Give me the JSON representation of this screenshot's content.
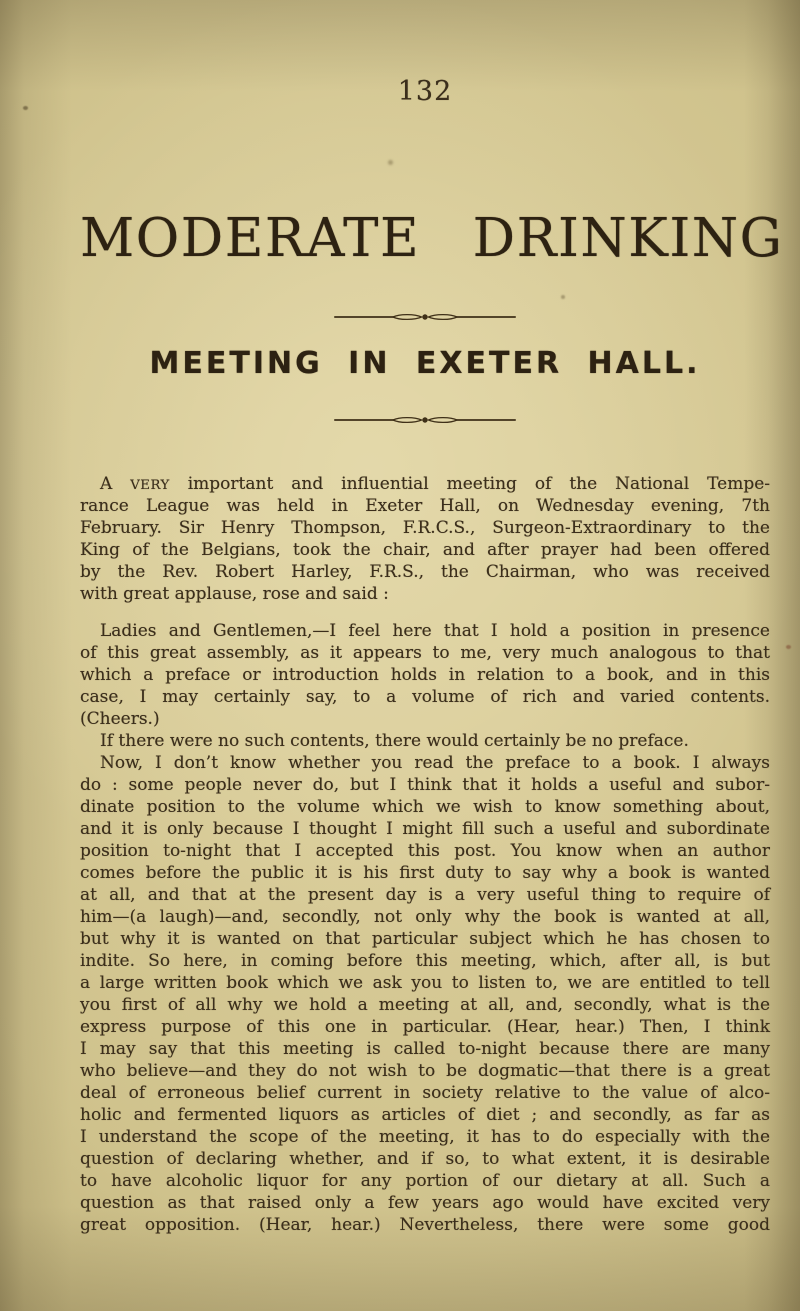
{
  "page_number": "132",
  "title": "MODERATE DRINKING",
  "heading": "MEETING IN EXETER HALL.",
  "ornament": "spindle-rule",
  "colors": {
    "paper": "#cfc28c",
    "paper_light": "#dbce9b",
    "paper_dark": "#a79860",
    "ink": "#3b2e1b",
    "ink_dark": "#2d2212",
    "rule": "#3f3018"
  },
  "body": {
    "paragraphs": [
      {
        "indent": true,
        "gap_before": 0,
        "lines": [
          {
            "justify": true,
            "segments": [
              {
                "s": "A "
              },
              {
                "s": "VERY",
                "sc": true
              },
              {
                "s": " important and influential meeting of the National Tempe-"
              }
            ]
          },
          {
            "justify": true,
            "segments": [
              {
                "s": "rance League was held in Exeter Hall, on Wednesday evening, 7th"
              }
            ]
          },
          {
            "justify": true,
            "segments": [
              {
                "s": "February. Sir Henry Thompson, F.R.C.S., Surgeon-Extraordinary to the"
              }
            ]
          },
          {
            "justify": true,
            "segments": [
              {
                "s": "King of the Belgians, took the chair, and after prayer had been offered"
              }
            ]
          },
          {
            "justify": true,
            "segments": [
              {
                "s": "by the Rev. Robert Harley, F.R.S., the Chairman, who was received"
              }
            ]
          },
          {
            "justify": false,
            "segments": [
              {
                "s": "with great applause, rose and said :"
              }
            ]
          }
        ]
      },
      {
        "indent": true,
        "gap_before": 15,
        "lines": [
          {
            "justify": true,
            "segments": [
              {
                "s": "Ladies and Gentlemen,—I feel here that I hold a position in presence"
              }
            ]
          },
          {
            "justify": true,
            "segments": [
              {
                "s": "of this great assembly, as it appears to me, very much analogous to that"
              }
            ]
          },
          {
            "justify": true,
            "segments": [
              {
                "s": "which a preface or introduction holds in relation to a book, and in this"
              }
            ]
          },
          {
            "justify": true,
            "segments": [
              {
                "s": "case, I may certainly say, to a volume of rich and varied contents."
              }
            ]
          },
          {
            "justify": false,
            "segments": [
              {
                "s": "(Cheers.)"
              }
            ]
          }
        ]
      },
      {
        "indent": true,
        "gap_before": 0,
        "lines": [
          {
            "justify": false,
            "segments": [
              {
                "s": "If there were no such contents, there would certainly be no preface."
              }
            ]
          }
        ]
      },
      {
        "indent": true,
        "gap_before": 0,
        "lines": [
          {
            "justify": true,
            "segments": [
              {
                "s": "Now, I don’t know whether you read the preface to a book. I always"
              }
            ]
          },
          {
            "justify": true,
            "segments": [
              {
                "s": "do : some people never do, but I think that it holds a useful and subor-"
              }
            ]
          },
          {
            "justify": true,
            "segments": [
              {
                "s": "dinate position to the volume which we wish to know something about,"
              }
            ]
          },
          {
            "justify": true,
            "segments": [
              {
                "s": "and it is only because I thought I might fill such a useful and subordinate"
              }
            ]
          },
          {
            "justify": true,
            "segments": [
              {
                "s": "position to-night that I accepted this post. You know when an author"
              }
            ]
          },
          {
            "justify": true,
            "segments": [
              {
                "s": "comes before the public it is his first duty to say why a book is wanted"
              }
            ]
          },
          {
            "justify": true,
            "segments": [
              {
                "s": "at all, and that at the present day is a very useful thing to require of"
              }
            ]
          },
          {
            "justify": true,
            "segments": [
              {
                "s": "him—(a laugh)—and, secondly, not only why the book is wanted at all,"
              }
            ]
          },
          {
            "justify": true,
            "segments": [
              {
                "s": "but why it is wanted on that particular subject which he has chosen to"
              }
            ]
          },
          {
            "justify": true,
            "segments": [
              {
                "s": "indite. So here, in coming before this meeting, which, after all, is but"
              }
            ]
          },
          {
            "justify": true,
            "segments": [
              {
                "s": "a large written book which we ask you to listen to, we are entitled to tell"
              }
            ]
          },
          {
            "justify": true,
            "segments": [
              {
                "s": "you first of all why we hold a meeting at all, and, secondly, what is the"
              }
            ]
          },
          {
            "justify": true,
            "segments": [
              {
                "s": "express purpose of this one in particular. (Hear, hear.) Then, I think"
              }
            ]
          },
          {
            "justify": true,
            "segments": [
              {
                "s": "I may say that this meeting is called to-night because there are many"
              }
            ]
          },
          {
            "justify": true,
            "segments": [
              {
                "s": "who believe—and they do not wish to be dogmatic—that there is a great"
              }
            ]
          },
          {
            "justify": true,
            "segments": [
              {
                "s": "deal of erroneous belief current in society relative to the value of alco-"
              }
            ]
          },
          {
            "justify": true,
            "segments": [
              {
                "s": "holic and fermented liquors as articles of diet ; and secondly, as far as"
              }
            ]
          },
          {
            "justify": true,
            "segments": [
              {
                "s": "I understand the scope of the meeting, it has to do especially with the"
              }
            ]
          },
          {
            "justify": true,
            "segments": [
              {
                "s": "question of declaring whether, and if so, to what extent, it is desirable"
              }
            ]
          },
          {
            "justify": true,
            "segments": [
              {
                "s": "to have alcoholic liquor for any portion of our dietary at all. Such a"
              }
            ]
          },
          {
            "justify": true,
            "segments": [
              {
                "s": "question as that raised only a few years ago would have excited very"
              }
            ]
          },
          {
            "justify": true,
            "segments": [
              {
                "s": "great opposition. (Hear, hear.) Nevertheless, there were some good"
              }
            ]
          }
        ]
      }
    ]
  }
}
